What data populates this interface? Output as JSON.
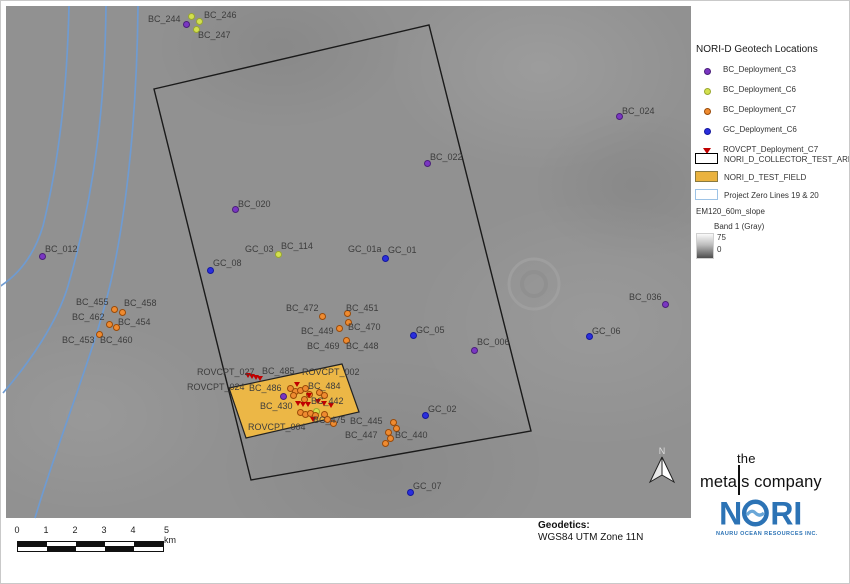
{
  "legend": {
    "title": "NORI-D Geotech Locations",
    "point_items": [
      {
        "label": "BC_Deployment_C3",
        "type": "c3"
      },
      {
        "label": "BC_Deployment_C6",
        "type": "c6"
      },
      {
        "label": "BC_Deployment_C7",
        "type": "c7"
      },
      {
        "label": "GC_Deployment_C6",
        "type": "gc"
      },
      {
        "label": "ROVCPT_Deployment_C7",
        "type": "rov"
      }
    ],
    "shape_items": [
      {
        "label": "NORI_D_COLLECTOR_TEST_AREA",
        "fill": "#ffffff",
        "border": "#000000"
      },
      {
        "label": "NORI_D_TEST_FIELD",
        "fill": "#eab33f",
        "border": "#8a7a40"
      },
      {
        "label": "Project Zero Lines 19 & 20",
        "fill": "#ffffff",
        "border": "#9dc3e6"
      }
    ],
    "raster": {
      "name": "EM120_60m_slope",
      "band": "Band 1 (Gray)",
      "max": "75",
      "min": "0"
    }
  },
  "marker_colors": {
    "c3": {
      "fill": "#7a36c2",
      "edge": "#4a1f7a"
    },
    "c6": {
      "fill": "#d3e04e",
      "edge": "#9aa82f"
    },
    "c7": {
      "fill": "#ef8b30",
      "edge": "#9a4a08"
    },
    "gc": {
      "fill": "#2a2edd",
      "edge": "#14189e"
    },
    "rov": {
      "fill": "#c00000",
      "edge": "#8a0000"
    }
  },
  "map": {
    "labels": [
      {
        "t": "BC_244",
        "x": 147,
        "y": 13
      },
      {
        "t": "BC_246",
        "x": 203,
        "y": 9
      },
      {
        "t": "BC_247",
        "x": 197,
        "y": 29
      },
      {
        "t": "BC_024",
        "x": 621,
        "y": 105
      },
      {
        "t": "BC_022",
        "x": 429,
        "y": 151
      },
      {
        "t": "BC_020",
        "x": 237,
        "y": 198
      },
      {
        "t": "GC_03",
        "x": 244,
        "y": 243
      },
      {
        "t": "BC_114",
        "x": 280,
        "y": 240
      },
      {
        "t": "GC_01a",
        "x": 347,
        "y": 243
      },
      {
        "t": "GC_01",
        "x": 387,
        "y": 244
      },
      {
        "t": "GC_08",
        "x": 212,
        "y": 257
      },
      {
        "t": "BC_012",
        "x": 44,
        "y": 243
      },
      {
        "t": "BC_455",
        "x": 75,
        "y": 296
      },
      {
        "t": "BC_458",
        "x": 123,
        "y": 297
      },
      {
        "t": "BC_462",
        "x": 71,
        "y": 311
      },
      {
        "t": "BC_454",
        "x": 117,
        "y": 316
      },
      {
        "t": "BC_453",
        "x": 61,
        "y": 334
      },
      {
        "t": "BC_460",
        "x": 99,
        "y": 334
      },
      {
        "t": "BC_472",
        "x": 285,
        "y": 302
      },
      {
        "t": "BC_451",
        "x": 345,
        "y": 302
      },
      {
        "t": "BC_449",
        "x": 300,
        "y": 325
      },
      {
        "t": "BC_470",
        "x": 347,
        "y": 321
      },
      {
        "t": "BC_469",
        "x": 306,
        "y": 340
      },
      {
        "t": "BC_448",
        "x": 345,
        "y": 340
      },
      {
        "t": "GC_05",
        "x": 415,
        "y": 324
      },
      {
        "t": "BC_006",
        "x": 476,
        "y": 336
      },
      {
        "t": "GC_06",
        "x": 591,
        "y": 325
      },
      {
        "t": "BC_036",
        "x": 628,
        "y": 291
      },
      {
        "t": "ROVCPT_027",
        "x": 196,
        "y": 366
      },
      {
        "t": "BC_485",
        "x": 261,
        "y": 365
      },
      {
        "t": "ROVCPT_002",
        "x": 301,
        "y": 366
      },
      {
        "t": "ROVCPT_024",
        "x": 186,
        "y": 381
      },
      {
        "t": "BC_486",
        "x": 248,
        "y": 382
      },
      {
        "t": "BC_484",
        "x": 307,
        "y": 380
      },
      {
        "t": "BC_430",
        "x": 259,
        "y": 400
      },
      {
        "t": "BC_442",
        "x": 310,
        "y": 395
      },
      {
        "t": "BC_475",
        "x": 312,
        "y": 414
      },
      {
        "t": "BC_445",
        "x": 349,
        "y": 415
      },
      {
        "t": "ROVCPT_004",
        "x": 247,
        "y": 421
      },
      {
        "t": "BC_447",
        "x": 344,
        "y": 429
      },
      {
        "t": "BC_440",
        "x": 394,
        "y": 429
      },
      {
        "t": "GC_02",
        "x": 427,
        "y": 403
      },
      {
        "t": "GC_07",
        "x": 412,
        "y": 480
      }
    ],
    "dots": [
      {
        "x": 184,
        "y": 22,
        "t": "c3"
      },
      {
        "x": 233,
        "y": 207,
        "t": "c3"
      },
      {
        "x": 425,
        "y": 161,
        "t": "c3"
      },
      {
        "x": 617,
        "y": 114,
        "t": "c3"
      },
      {
        "x": 40,
        "y": 254,
        "t": "c3"
      },
      {
        "x": 472,
        "y": 348,
        "t": "c3"
      },
      {
        "x": 663,
        "y": 302,
        "t": "c3"
      },
      {
        "x": 281,
        "y": 394,
        "t": "c3"
      },
      {
        "x": 189,
        "y": 14,
        "t": "c6"
      },
      {
        "x": 197,
        "y": 19,
        "t": "c6"
      },
      {
        "x": 194,
        "y": 27,
        "t": "c6"
      },
      {
        "x": 276,
        "y": 252,
        "t": "c6"
      },
      {
        "x": 314,
        "y": 409,
        "t": "c6"
      },
      {
        "x": 112,
        "y": 307,
        "t": "c7"
      },
      {
        "x": 120,
        "y": 310,
        "t": "c7"
      },
      {
        "x": 107,
        "y": 322,
        "t": "c7"
      },
      {
        "x": 114,
        "y": 325,
        "t": "c7"
      },
      {
        "x": 97,
        "y": 332,
        "t": "c7"
      },
      {
        "x": 320,
        "y": 314,
        "t": "c7"
      },
      {
        "x": 345,
        "y": 311,
        "t": "c7"
      },
      {
        "x": 346,
        "y": 320,
        "t": "c7"
      },
      {
        "x": 337,
        "y": 326,
        "t": "c7"
      },
      {
        "x": 344,
        "y": 338,
        "t": "c7"
      },
      {
        "x": 391,
        "y": 420,
        "t": "c7"
      },
      {
        "x": 394,
        "y": 426,
        "t": "c7"
      },
      {
        "x": 386,
        "y": 430,
        "t": "c7"
      },
      {
        "x": 388,
        "y": 436,
        "t": "c7"
      },
      {
        "x": 383,
        "y": 441,
        "t": "c7"
      },
      {
        "x": 288,
        "y": 386,
        "t": "c7"
      },
      {
        "x": 293,
        "y": 389,
        "t": "c7"
      },
      {
        "x": 298,
        "y": 388,
        "t": "c7"
      },
      {
        "x": 303,
        "y": 386,
        "t": "c7"
      },
      {
        "x": 307,
        "y": 392,
        "t": "c7"
      },
      {
        "x": 302,
        "y": 397,
        "t": "c7"
      },
      {
        "x": 291,
        "y": 393,
        "t": "c7"
      },
      {
        "x": 317,
        "y": 390,
        "t": "c7"
      },
      {
        "x": 322,
        "y": 393,
        "t": "c7"
      },
      {
        "x": 298,
        "y": 410,
        "t": "c7"
      },
      {
        "x": 303,
        "y": 412,
        "t": "c7"
      },
      {
        "x": 308,
        "y": 411,
        "t": "c7"
      },
      {
        "x": 313,
        "y": 413,
        "t": "c7"
      },
      {
        "x": 322,
        "y": 412,
        "t": "c7"
      },
      {
        "x": 325,
        "y": 417,
        "t": "c7"
      },
      {
        "x": 331,
        "y": 421,
        "t": "c7"
      },
      {
        "x": 208,
        "y": 268,
        "t": "gc"
      },
      {
        "x": 383,
        "y": 256,
        "t": "gc"
      },
      {
        "x": 411,
        "y": 333,
        "t": "gc"
      },
      {
        "x": 587,
        "y": 334,
        "t": "gc"
      },
      {
        "x": 423,
        "y": 413,
        "t": "gc"
      },
      {
        "x": 408,
        "y": 490,
        "t": "gc"
      }
    ],
    "triangles": [
      {
        "x": 247,
        "y": 374
      },
      {
        "x": 251,
        "y": 375
      },
      {
        "x": 255,
        "y": 376
      },
      {
        "x": 259,
        "y": 377
      },
      {
        "x": 296,
        "y": 383
      },
      {
        "x": 308,
        "y": 394
      },
      {
        "x": 297,
        "y": 402
      },
      {
        "x": 302,
        "y": 403
      },
      {
        "x": 307,
        "y": 403
      },
      {
        "x": 317,
        "y": 400
      },
      {
        "x": 323,
        "y": 402
      },
      {
        "x": 312,
        "y": 418
      },
      {
        "x": 330,
        "y": 404
      }
    ],
    "collector_area_points": "153,88 428,24 530,430 250,479",
    "test_field_points": "228,387 341,363 358,411 245,437",
    "zero_line_paths": [
      "M 68,5 C 66,90 58,160 42,225 C 32,258 14,276 -2,286",
      "M 105,5 C 104,95 96,185 67,285 C 56,322 28,362 2,392",
      "M 137,5 C 136,105 127,205 110,280 C 94,350 58,436 34,517"
    ],
    "north_label": "N"
  },
  "scalebar": {
    "ticks": [
      "0",
      "1",
      "2",
      "3",
      "4"
    ],
    "end_label": "5 km"
  },
  "footer": {
    "geodetics_title": "Geodetics:",
    "geodetics_value": "WGS84 UTM Zone 11N"
  },
  "logos": {
    "tmc_the": "the",
    "tmc_meta": "meta",
    "tmc_rest": "s company",
    "nori": "NORI",
    "nori_color": "#2c73b5",
    "nori_sub": "NAURU OCEAN RESOURCES INC."
  }
}
